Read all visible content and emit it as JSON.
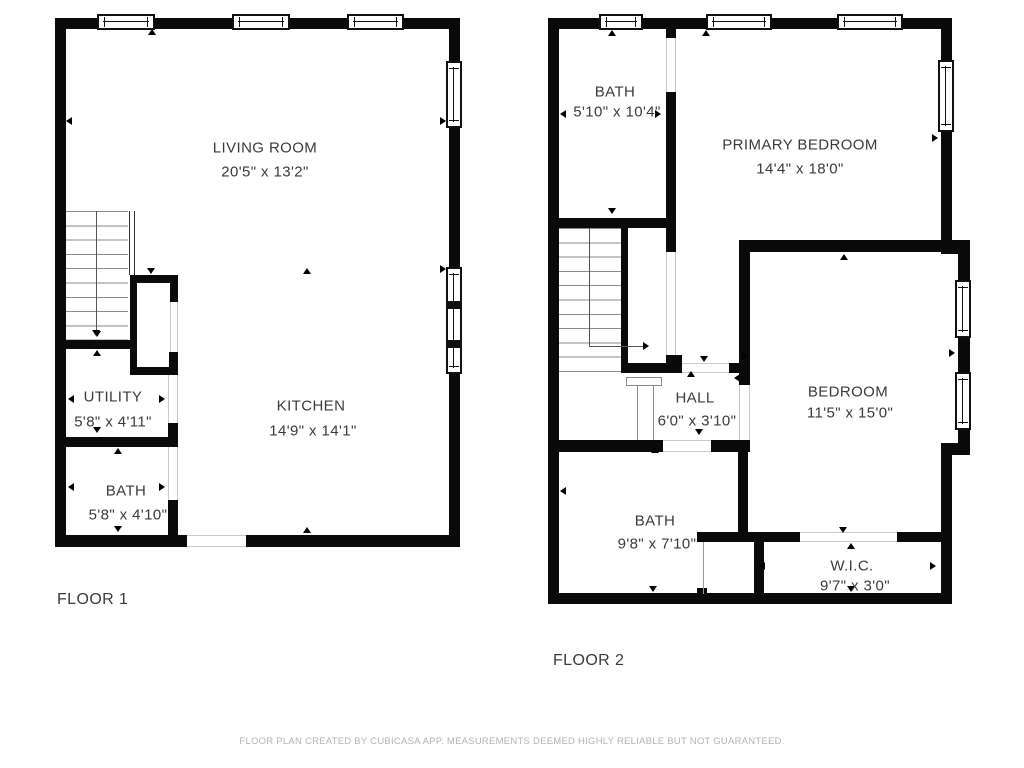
{
  "page": {
    "background": "#ffffff",
    "wall_color": "#0a0a0a",
    "text_color": "#3a3a3a",
    "footer_color": "#b3b3b3"
  },
  "floors": [
    {
      "label": "FLOOR 1",
      "rooms": [
        {
          "name": "LIVING ROOM",
          "dimensions": "20'5\" x 13'2\""
        },
        {
          "name": "KITCHEN",
          "dimensions": "14'9\" x 14'1\""
        },
        {
          "name": "UTILITY",
          "dimensions": "5'8\" x 4'11\""
        },
        {
          "name": "BATH",
          "dimensions": "5'8\" x 4'10\""
        }
      ]
    },
    {
      "label": "FLOOR 2",
      "rooms": [
        {
          "name": "BATH",
          "dimensions": "5'10\" x 10'4\""
        },
        {
          "name": "PRIMARY BEDROOM",
          "dimensions": "14'4\" x 18'0\""
        },
        {
          "name": "HALL",
          "dimensions": "6'0\" x 3'10\""
        },
        {
          "name": "BEDROOM",
          "dimensions": "11'5\" x 15'0\""
        },
        {
          "name": "BATH",
          "dimensions": "9'8\" x 7'10\""
        },
        {
          "name": "W.I.C.",
          "dimensions": "9'7\" x 3'0\""
        }
      ]
    }
  ],
  "footer": {
    "disclaimer": "FLOOR PLAN CREATED BY CUBICASA APP. MEASUREMENTS DEEMED HIGHLY RELIABLE BUT NOT GUARANTEED."
  }
}
